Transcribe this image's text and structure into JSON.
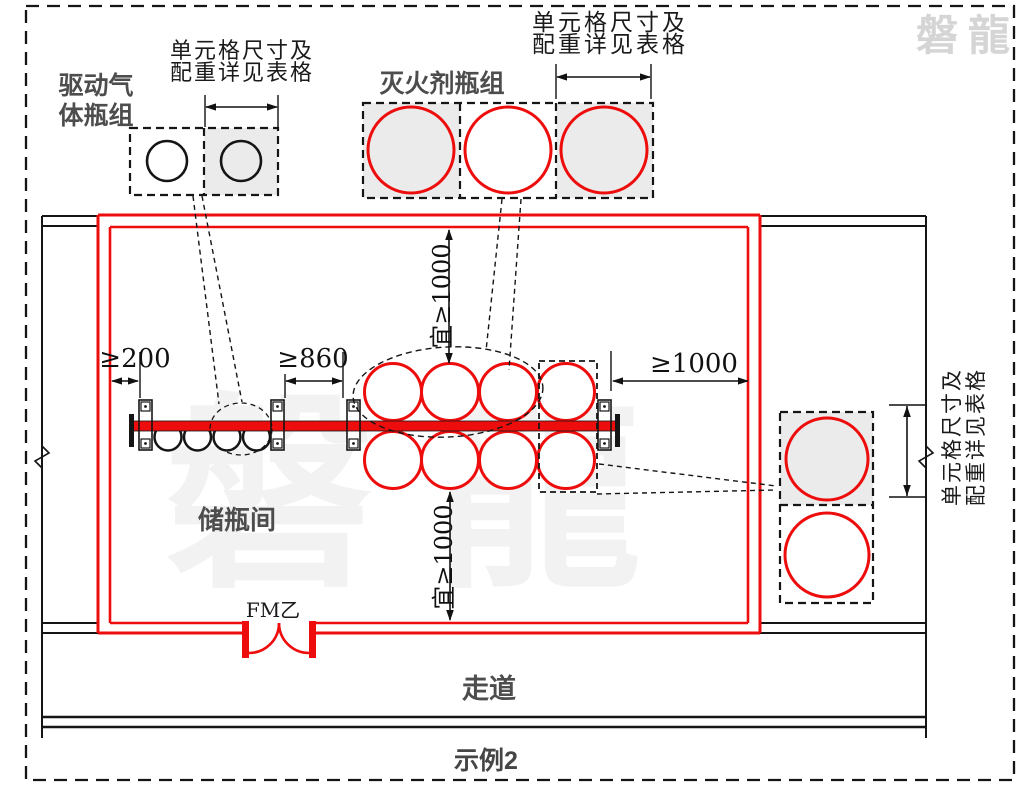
{
  "watermark": {
    "corner_text": "磐龍",
    "center_text": "磐龍"
  },
  "callouts": {
    "cell_note_line1": "单元格尺寸及",
    "cell_note_line2": "配重详见表格",
    "driving_gas_line1": "驱动气",
    "driving_gas_line2": "体瓶组",
    "agent_group": "灭火剂瓶组"
  },
  "room": {
    "name": "储瓶间",
    "door_label": "FM乙",
    "corridor": "走道",
    "caption": "示例2"
  },
  "dimensions": {
    "left_wall_gap": "≥200",
    "rack_gap": "≥860",
    "right_wall_gap": "≥1000",
    "aisle_top": "宜≥1000",
    "aisle_bottom": "宜≥1000",
    "unit_cell_top_left": "",
    "unit_cell_note_count": "3"
  },
  "colors": {
    "red": "#ee0d0d",
    "cell_fill": "#ebebeb",
    "label_gray": "#4d4d4d",
    "line_black": "#151515",
    "watermark_corner": "#d5d5d5"
  }
}
